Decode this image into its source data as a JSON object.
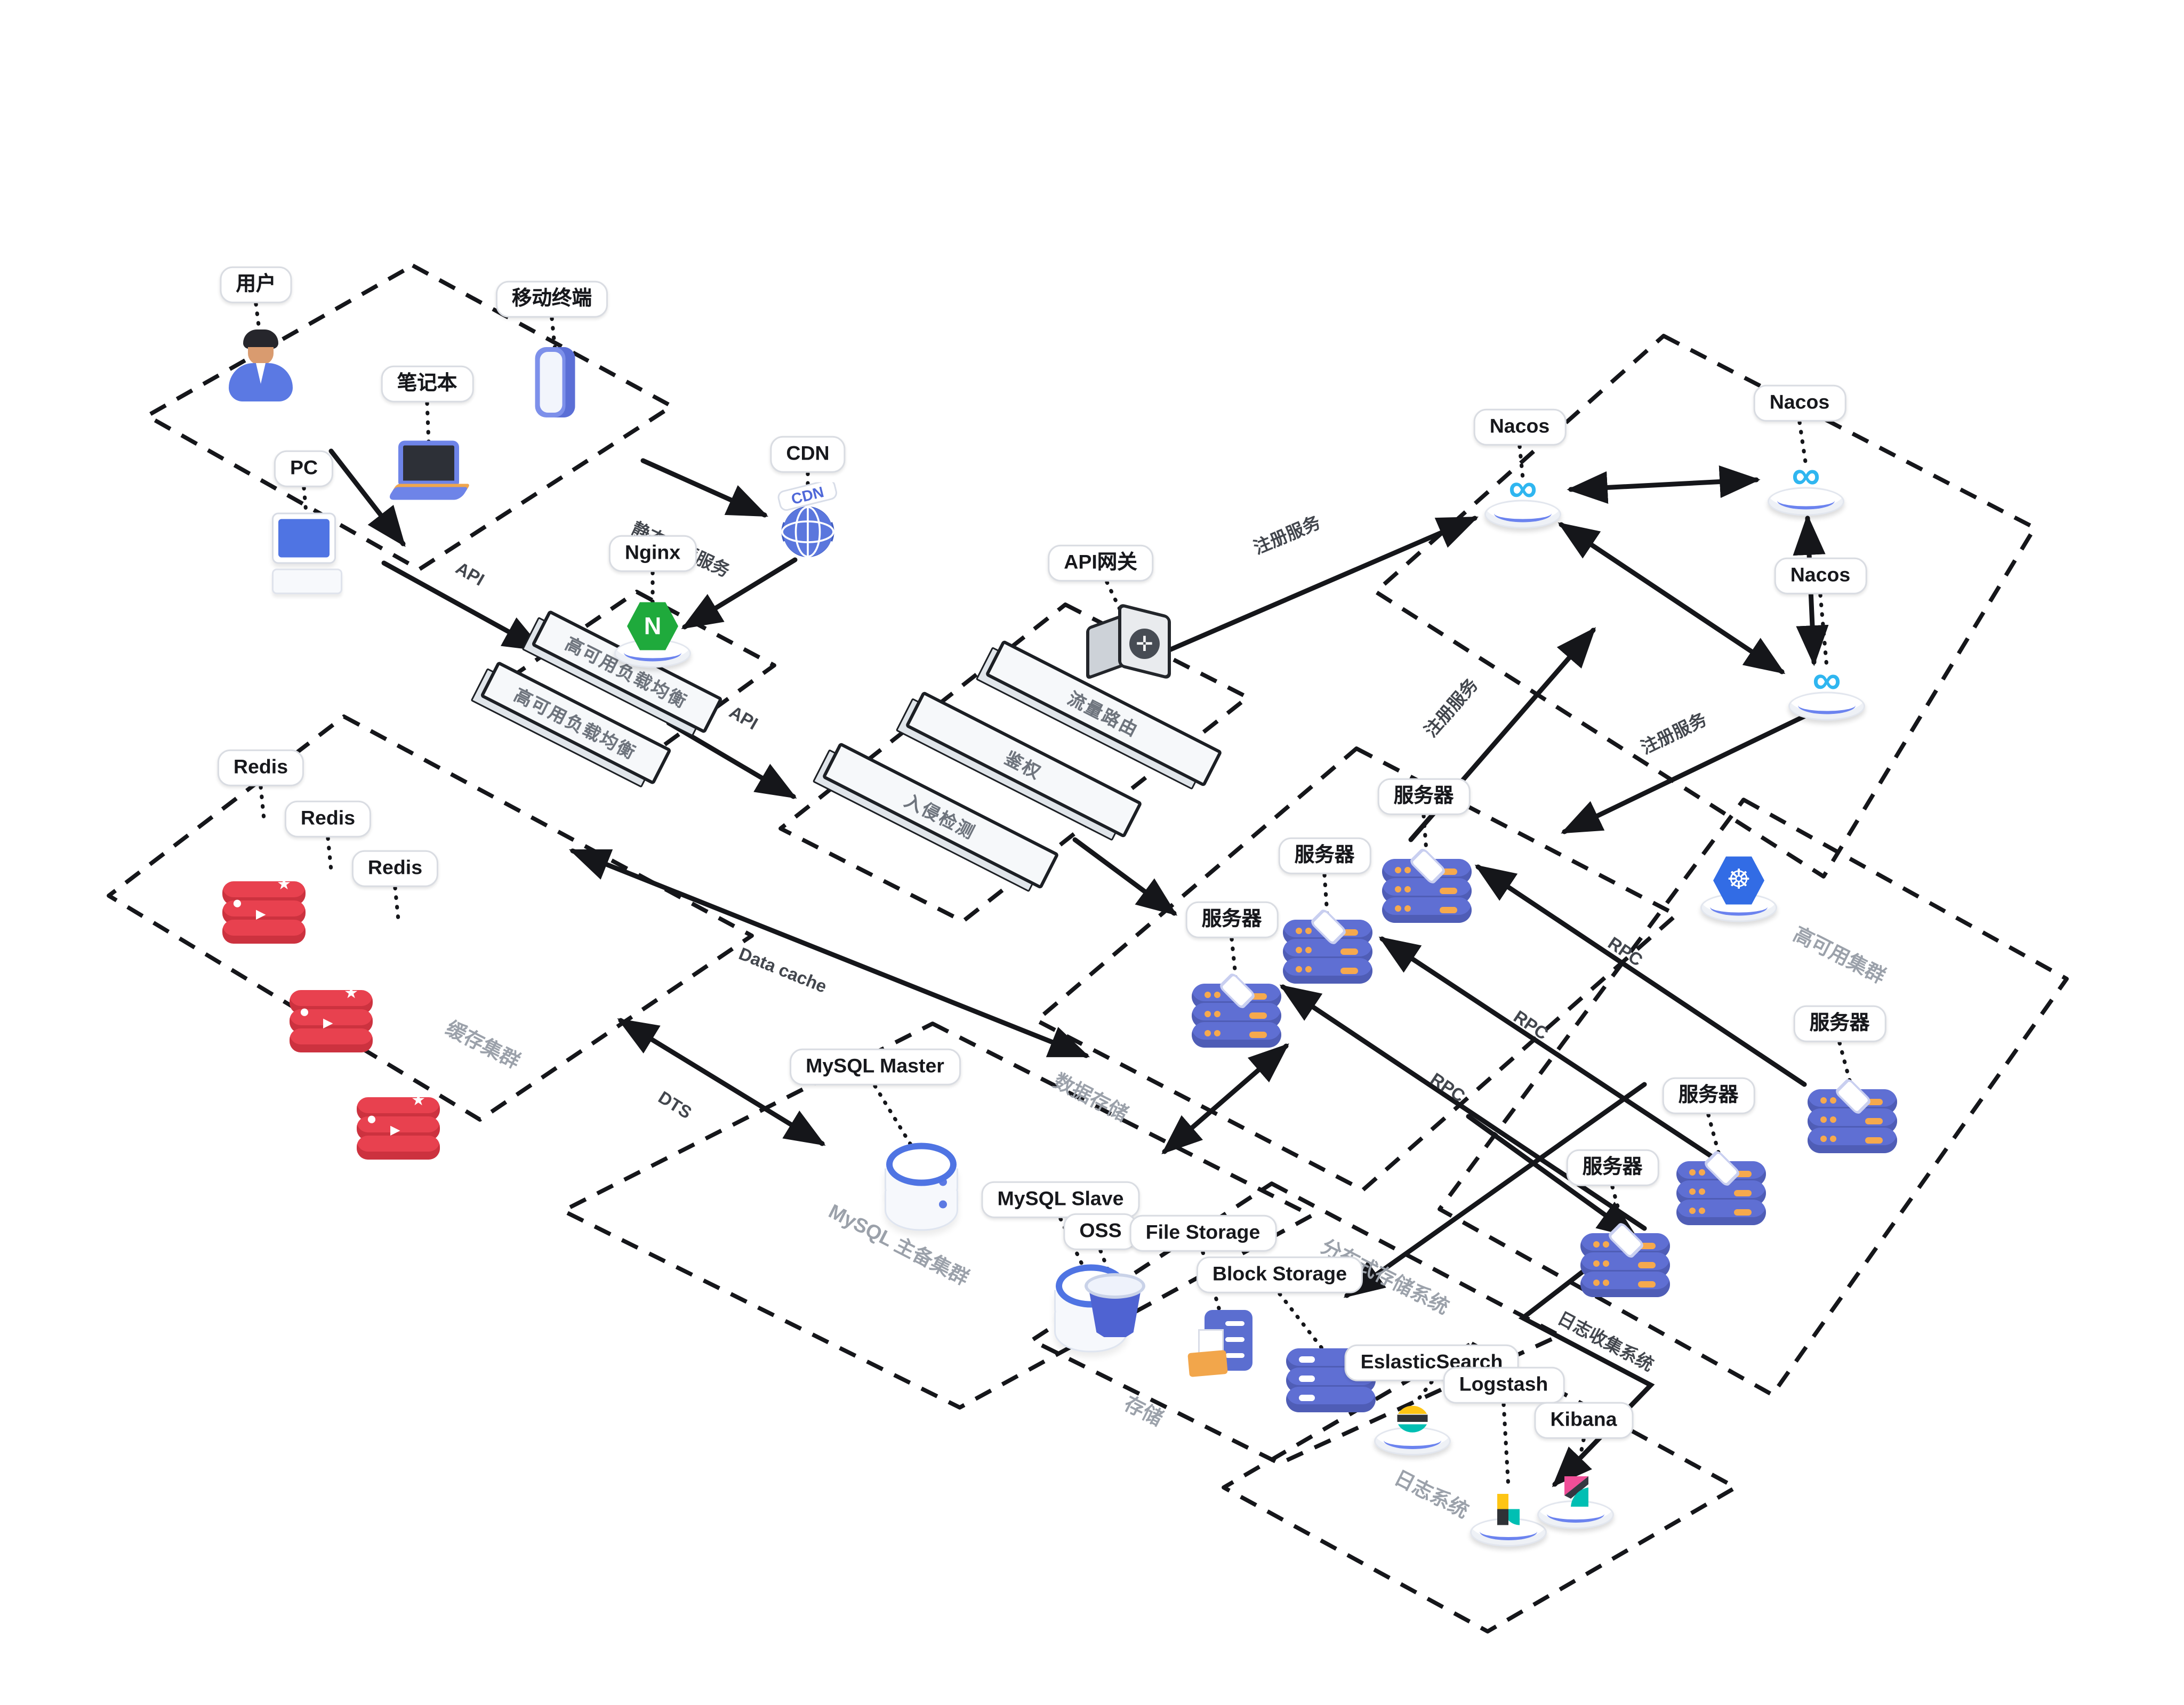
{
  "nodes": {
    "user": {
      "label": "用户"
    },
    "mobile": {
      "label": "移动终端"
    },
    "laptop": {
      "label": "笔记本"
    },
    "pc": {
      "label": "PC"
    },
    "cdn": {
      "label": "CDN",
      "icon_text": "CDN"
    },
    "nginx": {
      "label": "Nginx",
      "icon_letter": "N"
    },
    "load_balancers": [
      "高可用负载均衡",
      "高可用负载均衡"
    ],
    "api_gateway": {
      "label": "API网关"
    },
    "gateway_features": [
      "流量路由",
      "鉴权",
      "入侵检测"
    ],
    "nacos": [
      "Nacos",
      "Nacos",
      "Nacos"
    ],
    "servers": [
      "服务器",
      "服务器",
      "服务器",
      "服务器",
      "服务器",
      "服务器"
    ],
    "redis": [
      "Redis",
      "Redis",
      "Redis"
    ],
    "mysql_master": {
      "label": "MySQL Master"
    },
    "mysql_slave": {
      "label": "MySQL Slave"
    },
    "oss": {
      "label": "OSS"
    },
    "file_storage": {
      "label": "File Storage"
    },
    "block_storage": {
      "label": "Block Storage"
    },
    "elasticsearch": {
      "label": "EslasticSearch"
    },
    "logstash": {
      "label": "Logstash"
    },
    "kibana": {
      "label": "Kibana"
    }
  },
  "regions": {
    "cache": {
      "label": "缓存集群"
    },
    "mysql_cluster": {
      "label": "MySQL 主备集群"
    },
    "data_store": {
      "label": "数据存储"
    },
    "ha": {
      "label": "高可用集群"
    },
    "distributed_storage": {
      "label": "分布式存储系统"
    },
    "storage": {
      "label": "存储"
    },
    "log": {
      "label": "日志系统"
    }
  },
  "edges": {
    "api_user": {
      "label": "API"
    },
    "api_gateway": {
      "label": "API"
    },
    "static_assets": {
      "label": "静态资源服务"
    },
    "register": [
      "注册服务",
      "注册服务",
      "注册服务"
    ],
    "rpc": [
      "RPC",
      "RPC",
      "RPC"
    ],
    "data_cache": {
      "label": "Data cache"
    },
    "dts": {
      "label": "DTS"
    },
    "log_collect": {
      "label": "日志收集系统"
    }
  },
  "icons": {
    "nacos_infinity": "∞",
    "k8s_helm": "☸",
    "gateway_cross": "✛",
    "redis_star": "★",
    "redis_circle": "●",
    "redis_triangle": "▶"
  },
  "colors": {
    "line_dark": "#15161a",
    "server_blue": "#5f6fd3",
    "redis_red": "#e8414f",
    "nginx_green": "#1faa3c",
    "k8s_blue": "#326ce5",
    "nacos_blue": "#2fb6f0",
    "mysql_ring": "#4f74e3",
    "folder_orange": "#f2a64b",
    "es_yellow": "#fec514",
    "es_teal": "#00bfb3",
    "kibana_pink": "#f04e98"
  }
}
